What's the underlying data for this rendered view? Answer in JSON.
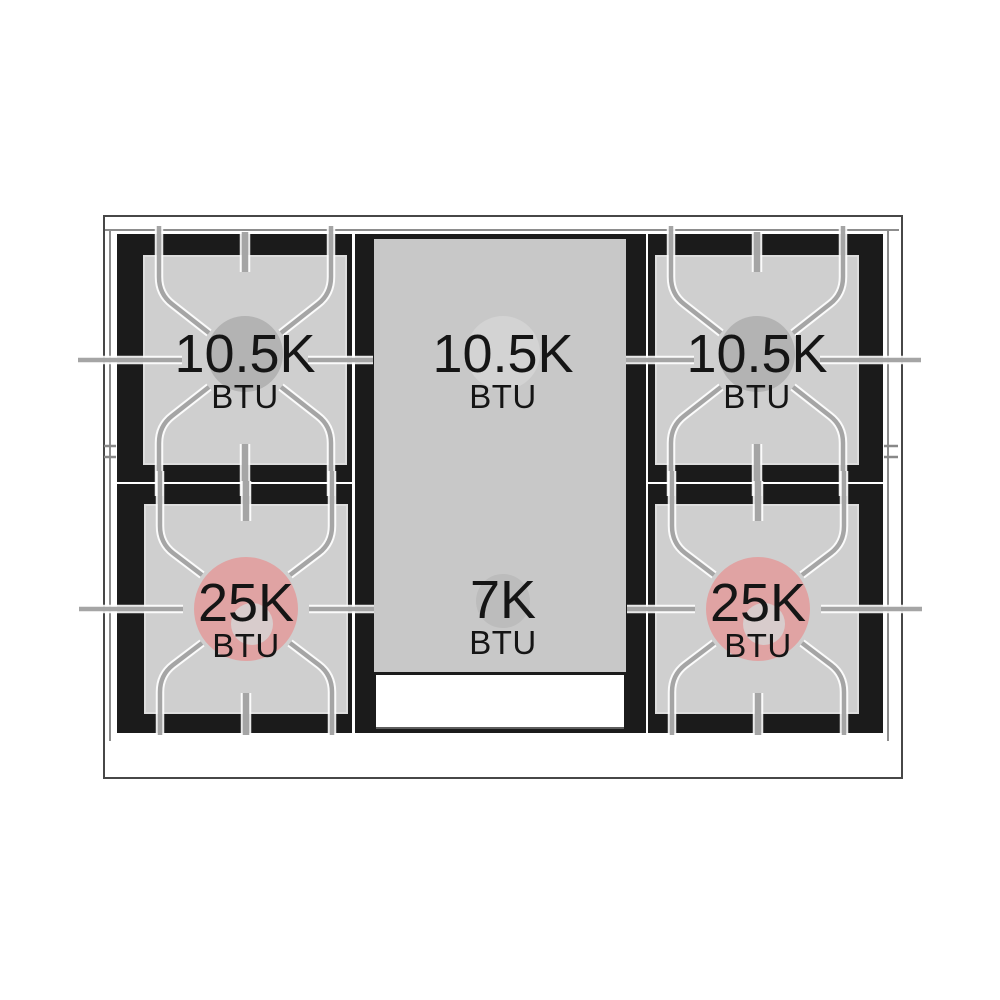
{
  "diagram": {
    "kind": "gas-range-cooktop-top-view",
    "burner_count_labeled": 6
  },
  "burners": [
    {
      "position": "top-left",
      "label": "10.5K",
      "unit": "BTU",
      "marker": "gray-circle"
    },
    {
      "position": "top-center",
      "label": "10.5K",
      "unit": "BTU",
      "marker": "light-gray-circle"
    },
    {
      "position": "top-right",
      "label": "10.5K",
      "unit": "BTU",
      "marker": "gray-circle"
    },
    {
      "position": "bottom-left",
      "label": "25K",
      "unit": "BTU",
      "marker": "pink-ring"
    },
    {
      "position": "bottom-center",
      "label": "7K",
      "unit": "BTU",
      "marker": "gray-circle-small"
    },
    {
      "position": "bottom-right",
      "label": "25K",
      "unit": "BTU",
      "marker": "pink-ring"
    }
  ],
  "colors": {
    "background": "#ffffff",
    "cooktop_black": "#1b1b1b",
    "burner_square_gray": "#cfcfcf",
    "center_panel_gray": "#c8c8c8",
    "burner_circle_gray": "#b3b3b3",
    "high_btu_ring_pink": "#e0a3a3",
    "grate_line_gray": "#a5a5a5",
    "text": "#151515"
  }
}
